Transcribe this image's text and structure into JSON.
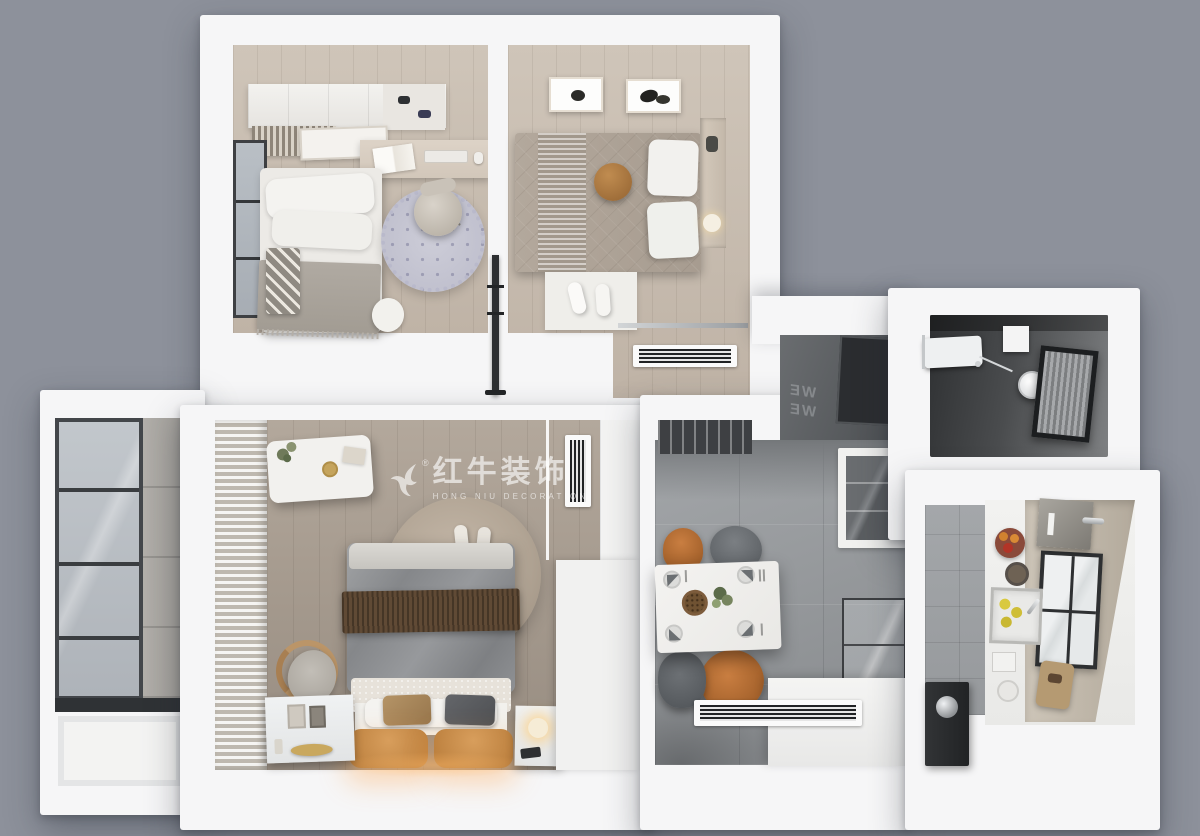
{
  "meta": {
    "title": "Top-down 3D rendered apartment floor plan",
    "view": "bird's-eye 3D render, white walls on gray background"
  },
  "watermark": {
    "cn": "红牛装饰",
    "en": "HONG NIU DECORATION",
    "reg": "®",
    "logo": "bull-swoosh-logo"
  },
  "entry": {
    "line1": "WE",
    "line2": "WE",
    "note": "mirrored lettering on dark entry floor"
  },
  "rooms": [
    {
      "id": "study-bedroom",
      "name": "Study / second bedroom (top-left): single bed, wall cabinets, bookshelf, desk with open book and keyboard, office chair, round polka-dot rug, floor cushion, window"
    },
    {
      "id": "small-bedroom",
      "name": "Small bedroom (top-right): double bed with taupe quilt, striped runner, round brown cushion, two framed artworks, bedside niche with lamp, slipper mat, linear AC vent"
    },
    {
      "id": "balcony",
      "name": "Balcony (left): floor-to-ceiling glazing, gray tile, white balustrade panel"
    },
    {
      "id": "master-bedroom",
      "name": "Master bedroom (bottom-center): double bed with gray duvet, brown throw, tan leather headboard with warm under-lighting, round fur rug, armchair, bench with plant, two nightstands, striped curtains, vertical AC vent, wardrobe"
    },
    {
      "id": "dining-room",
      "name": "Dining room: white marble table set for four, two orange and two gray chairs, glass display cabinet, glass shelf partition, white sideboard, linear AC vent"
    },
    {
      "id": "entry-hall",
      "name": "Entry hall: dark floor with mirrored WELCOME lettering and dark mat"
    },
    {
      "id": "shower-room",
      "name": "Shower room (top-right): rain shower head, towel rail, dark tile, curtained glass screen"
    },
    {
      "id": "kitchen",
      "name": "Kitchen (bottom-right): L-shaped white counter, sink with lemons, window, fruit bowls, cutting board, dispenser, dark tall appliance with kettle"
    }
  ],
  "palette": {
    "bg": "#8d919b",
    "wall": "#f6f6f7",
    "wall-dim": "#e8e9ea",
    "wood-light": "#c9bdb0",
    "wood-dark": "#a3988c",
    "tile": "#9da0a3",
    "dark-room": "#3c3e40",
    "entry-floor": "#5c5f62",
    "frame": "#3a3d40",
    "glass": "#bcc1c7",
    "duvet-gray": "#8c8e91",
    "throw-brown": "#5d4733",
    "headboard-tan": "#c9904f",
    "pillow-tan": "#a8875d",
    "pillow-dark": "#595b5e",
    "duvet-taupe": "#aca195",
    "cushion-brown": "#b07c44",
    "chair-orange": "#b96f35",
    "chair-gray": "#6d7174",
    "marble": "#f1f0ee",
    "rug-lilac": "#c8c8d4",
    "fur-rug": "#b4a797",
    "lemon": "#d9c93f",
    "watermark": "rgba(255,255,255,0.62)"
  }
}
